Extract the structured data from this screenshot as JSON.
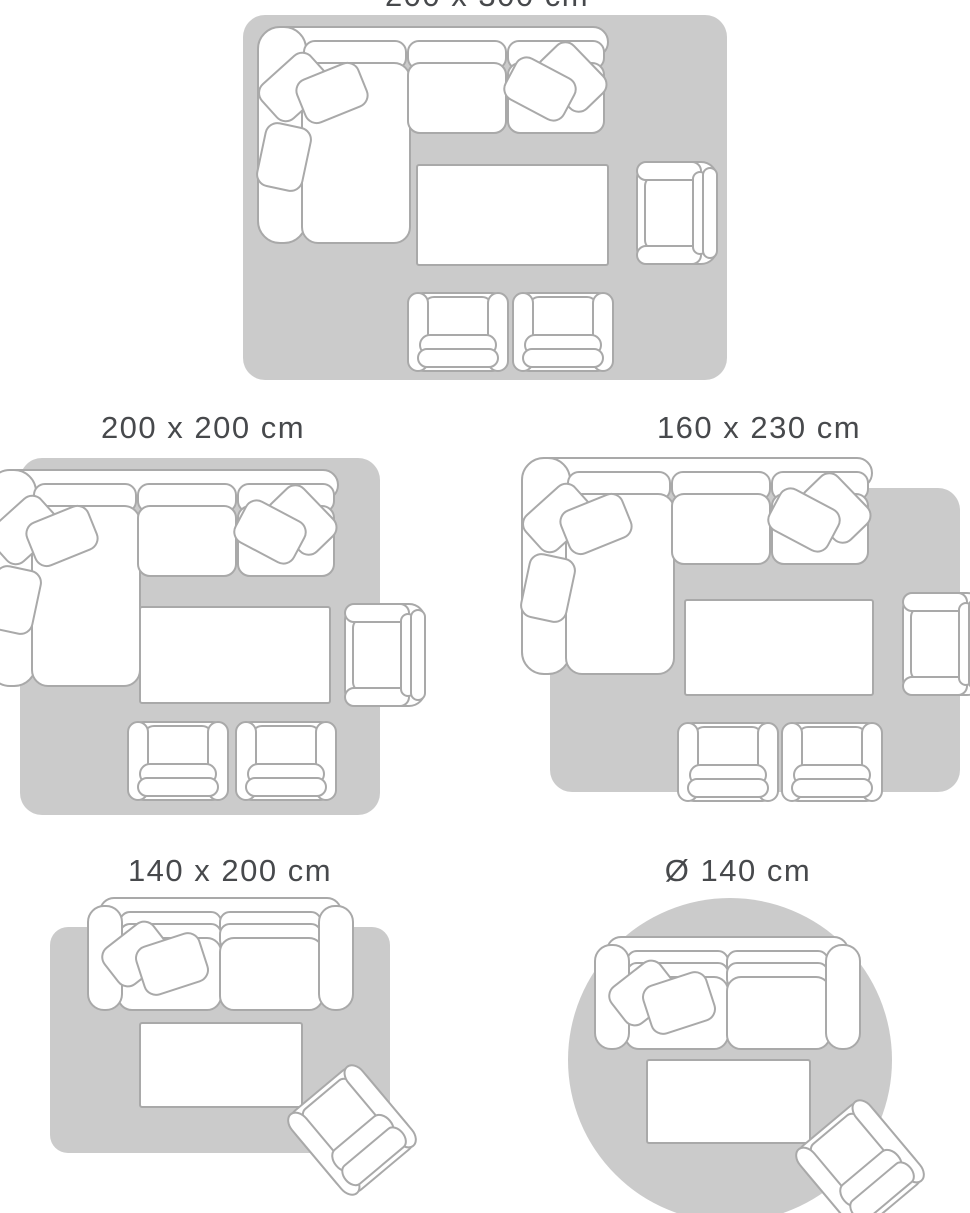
{
  "page": {
    "title": "Rug size guide with furniture layouts",
    "background": "#ffffff"
  },
  "colors": {
    "rug": "#cbcbcb",
    "furniture_outline": "#a9a9a9",
    "furniture_fill": "#ffffff",
    "title_text": "#47494c"
  },
  "layouts": [
    {
      "label": "200 x 300 cm",
      "rug_shape": "rectangle",
      "label_visibility": "partially cut off at top edge",
      "furniture": [
        "corner-sofa",
        "coffee-table",
        "armchair",
        "footstool-chair",
        "footstool-chair"
      ]
    },
    {
      "label": "200 x 200 cm",
      "rug_shape": "rectangle",
      "label_visibility": "fully visible",
      "furniture": [
        "corner-sofa",
        "coffee-table",
        "armchair",
        "footstool-chair",
        "footstool-chair"
      ]
    },
    {
      "label": "160 x 230 cm",
      "rug_shape": "rectangle",
      "label_visibility": "fully visible",
      "furniture": [
        "corner-sofa",
        "coffee-table",
        "armchair",
        "footstool-chair",
        "footstool-chair"
      ]
    },
    {
      "label": "140 x 200 cm",
      "rug_shape": "rectangle",
      "label_visibility": "fully visible",
      "furniture": [
        "two-seat-sofa",
        "coffee-table",
        "tilted-armchair"
      ]
    },
    {
      "label": "Ø 140 cm",
      "rug_shape": "circle",
      "label_visibility": "fully visible",
      "furniture": [
        "two-seat-sofa",
        "coffee-table",
        "tilted-armchair"
      ]
    }
  ]
}
